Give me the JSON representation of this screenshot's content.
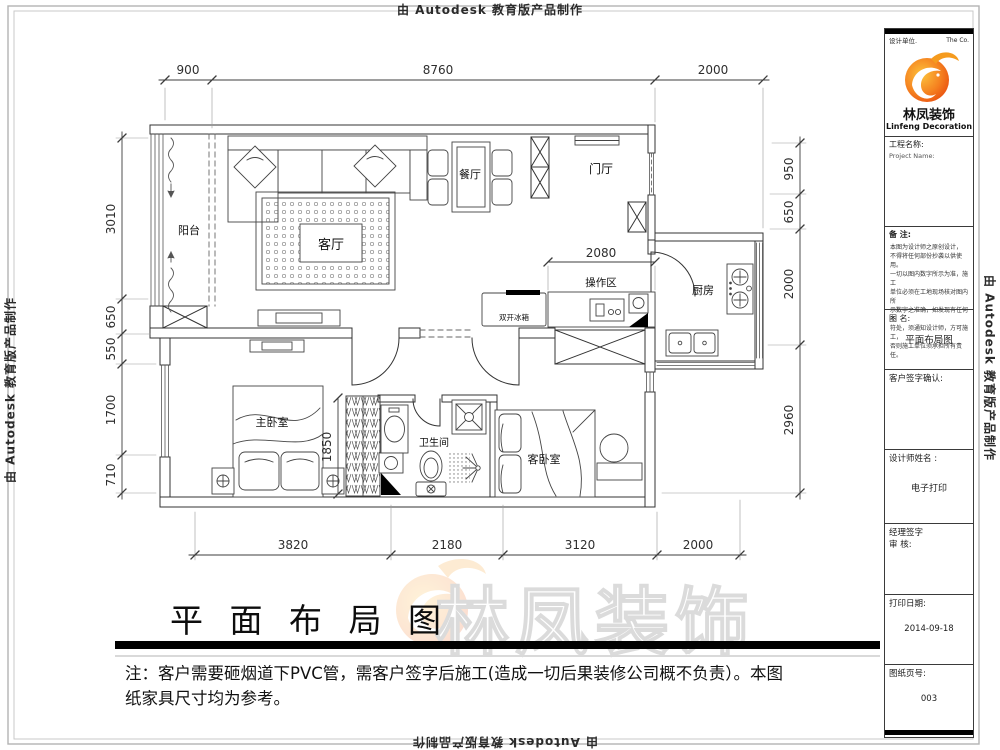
{
  "edge_labels": {
    "text": "由 Autodesk 教育版产品制作"
  },
  "plan": {
    "rooms": {
      "balcony": "阳台",
      "living": "客厅",
      "dining": "餐厅",
      "entry": "门厅",
      "work_area": "操作区",
      "kitchen": "厨房",
      "master_bedroom": "主卧室",
      "bathroom": "卫生间",
      "guest_bedroom": "客卧室"
    },
    "appliances": {
      "fridge": "双开冰箱"
    },
    "dims": {
      "top": [
        "900",
        "8760",
        "2000"
      ],
      "left": [
        "3010",
        "650",
        "550",
        "1700",
        "710"
      ],
      "right": [
        "950",
        "650",
        "2000",
        "2960"
      ],
      "bottom": [
        "3820",
        "2180",
        "3120",
        "2000"
      ],
      "interior": {
        "work_area": "2080",
        "bedroom": "1850"
      }
    }
  },
  "title_bar": {
    "title": "平 面 布 局 图",
    "note_line1": "注：客户需要砸烟道下PVC管，需客户签字后施工(造成一切后果装修公司概不负责）。本图",
    "note_line2": "纸家具尺寸均为参考。"
  },
  "watermark": {
    "brand": "林凤装饰"
  },
  "title_block": {
    "design_unit_label": "设计单位.",
    "company_short": "The  Co.",
    "brand_cn": "林凤装饰",
    "brand_en": "Linfeng Decoration",
    "project_label": "工程名称:",
    "project_label_en": "Project Name:",
    "remark_label": "备  注:",
    "remark_lines": [
      "本图为设计师之原创设计，",
      "不得将任何部份抄袭以供使用。",
      "一切以图内数字所示为准，施工",
      "单位必须在工地现场核对图内所",
      "示数字之准确，如发现有任何不",
      "符处，须通知设计师，方可施工，",
      "否则施工单位须承担所有责任。"
    ],
    "drawing_name_label": "图  名:",
    "drawing_name": "平面布局图",
    "client_sign_label": "客户签字确认:",
    "designer_label": "设计师姓名 :",
    "designer_value": "电子打印",
    "manager_sign_label": "经理签字",
    "review_label": "审  核:",
    "print_date_label": "打印日期:",
    "print_date": "2014-09-18",
    "sheet_label": "图纸页号:",
    "sheet_no": "003"
  },
  "colors": {
    "wall": "#333333",
    "dim": "#3c3c3c",
    "accent": "#f58220",
    "bar": "#000000"
  }
}
